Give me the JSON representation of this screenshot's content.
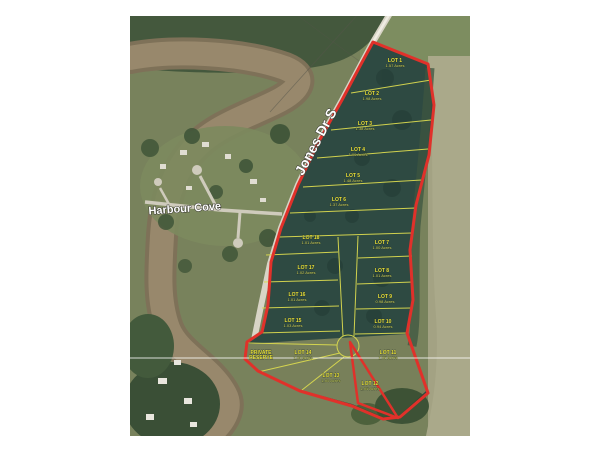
{
  "map": {
    "description": "Aerial plat map of 18-lot subdivision outlined in red",
    "streets": {
      "jones": "Jones Dr S",
      "harbour": "Harbour Cove"
    },
    "reserve": {
      "line1": "PRIVATE",
      "line2": "RESERVE"
    },
    "lots": [
      {
        "name": "LOT 1",
        "acres": "1.57  Acres"
      },
      {
        "name": "LOT 2",
        "acres": "1.98  Acres"
      },
      {
        "name": "LOT 3",
        "acres": "1.38  Acres"
      },
      {
        "name": "LOT 4",
        "acres": "1.99  Acres"
      },
      {
        "name": "LOT 5",
        "acres": "1.48  Acres"
      },
      {
        "name": "LOT 6",
        "acres": "1.37  Acres"
      },
      {
        "name": "LOT 7",
        "acres": "1.00  Acres"
      },
      {
        "name": "LOT 8",
        "acres": "1.01  Acres"
      },
      {
        "name": "LOT 9",
        "acres": "0.98  Acres"
      },
      {
        "name": "LOT 10",
        "acres": "0.94  Acres"
      },
      {
        "name": "LOT 11",
        "acres": "1.05  Acres"
      },
      {
        "name": "LOT 12",
        "acres": "1.05  Acres"
      },
      {
        "name": "LOT 13",
        "acres": "1.00  Acres"
      },
      {
        "name": "LOT 14",
        "acres": "1.00  Acres"
      },
      {
        "name": "LOT 15",
        "acres": "1.03  Acres"
      },
      {
        "name": "LOT 16",
        "acres": "1.01  Acres"
      },
      {
        "name": "LOT 17",
        "acres": "1.02  Acres"
      },
      {
        "name": "LOT 18",
        "acres": "1.01  Acres"
      }
    ],
    "colors": {
      "boundary_red": "#e0312a",
      "lot_line_yellow": "#d9d94f",
      "label_yellow": "#eae23c",
      "street_white": "#ffffff"
    }
  }
}
